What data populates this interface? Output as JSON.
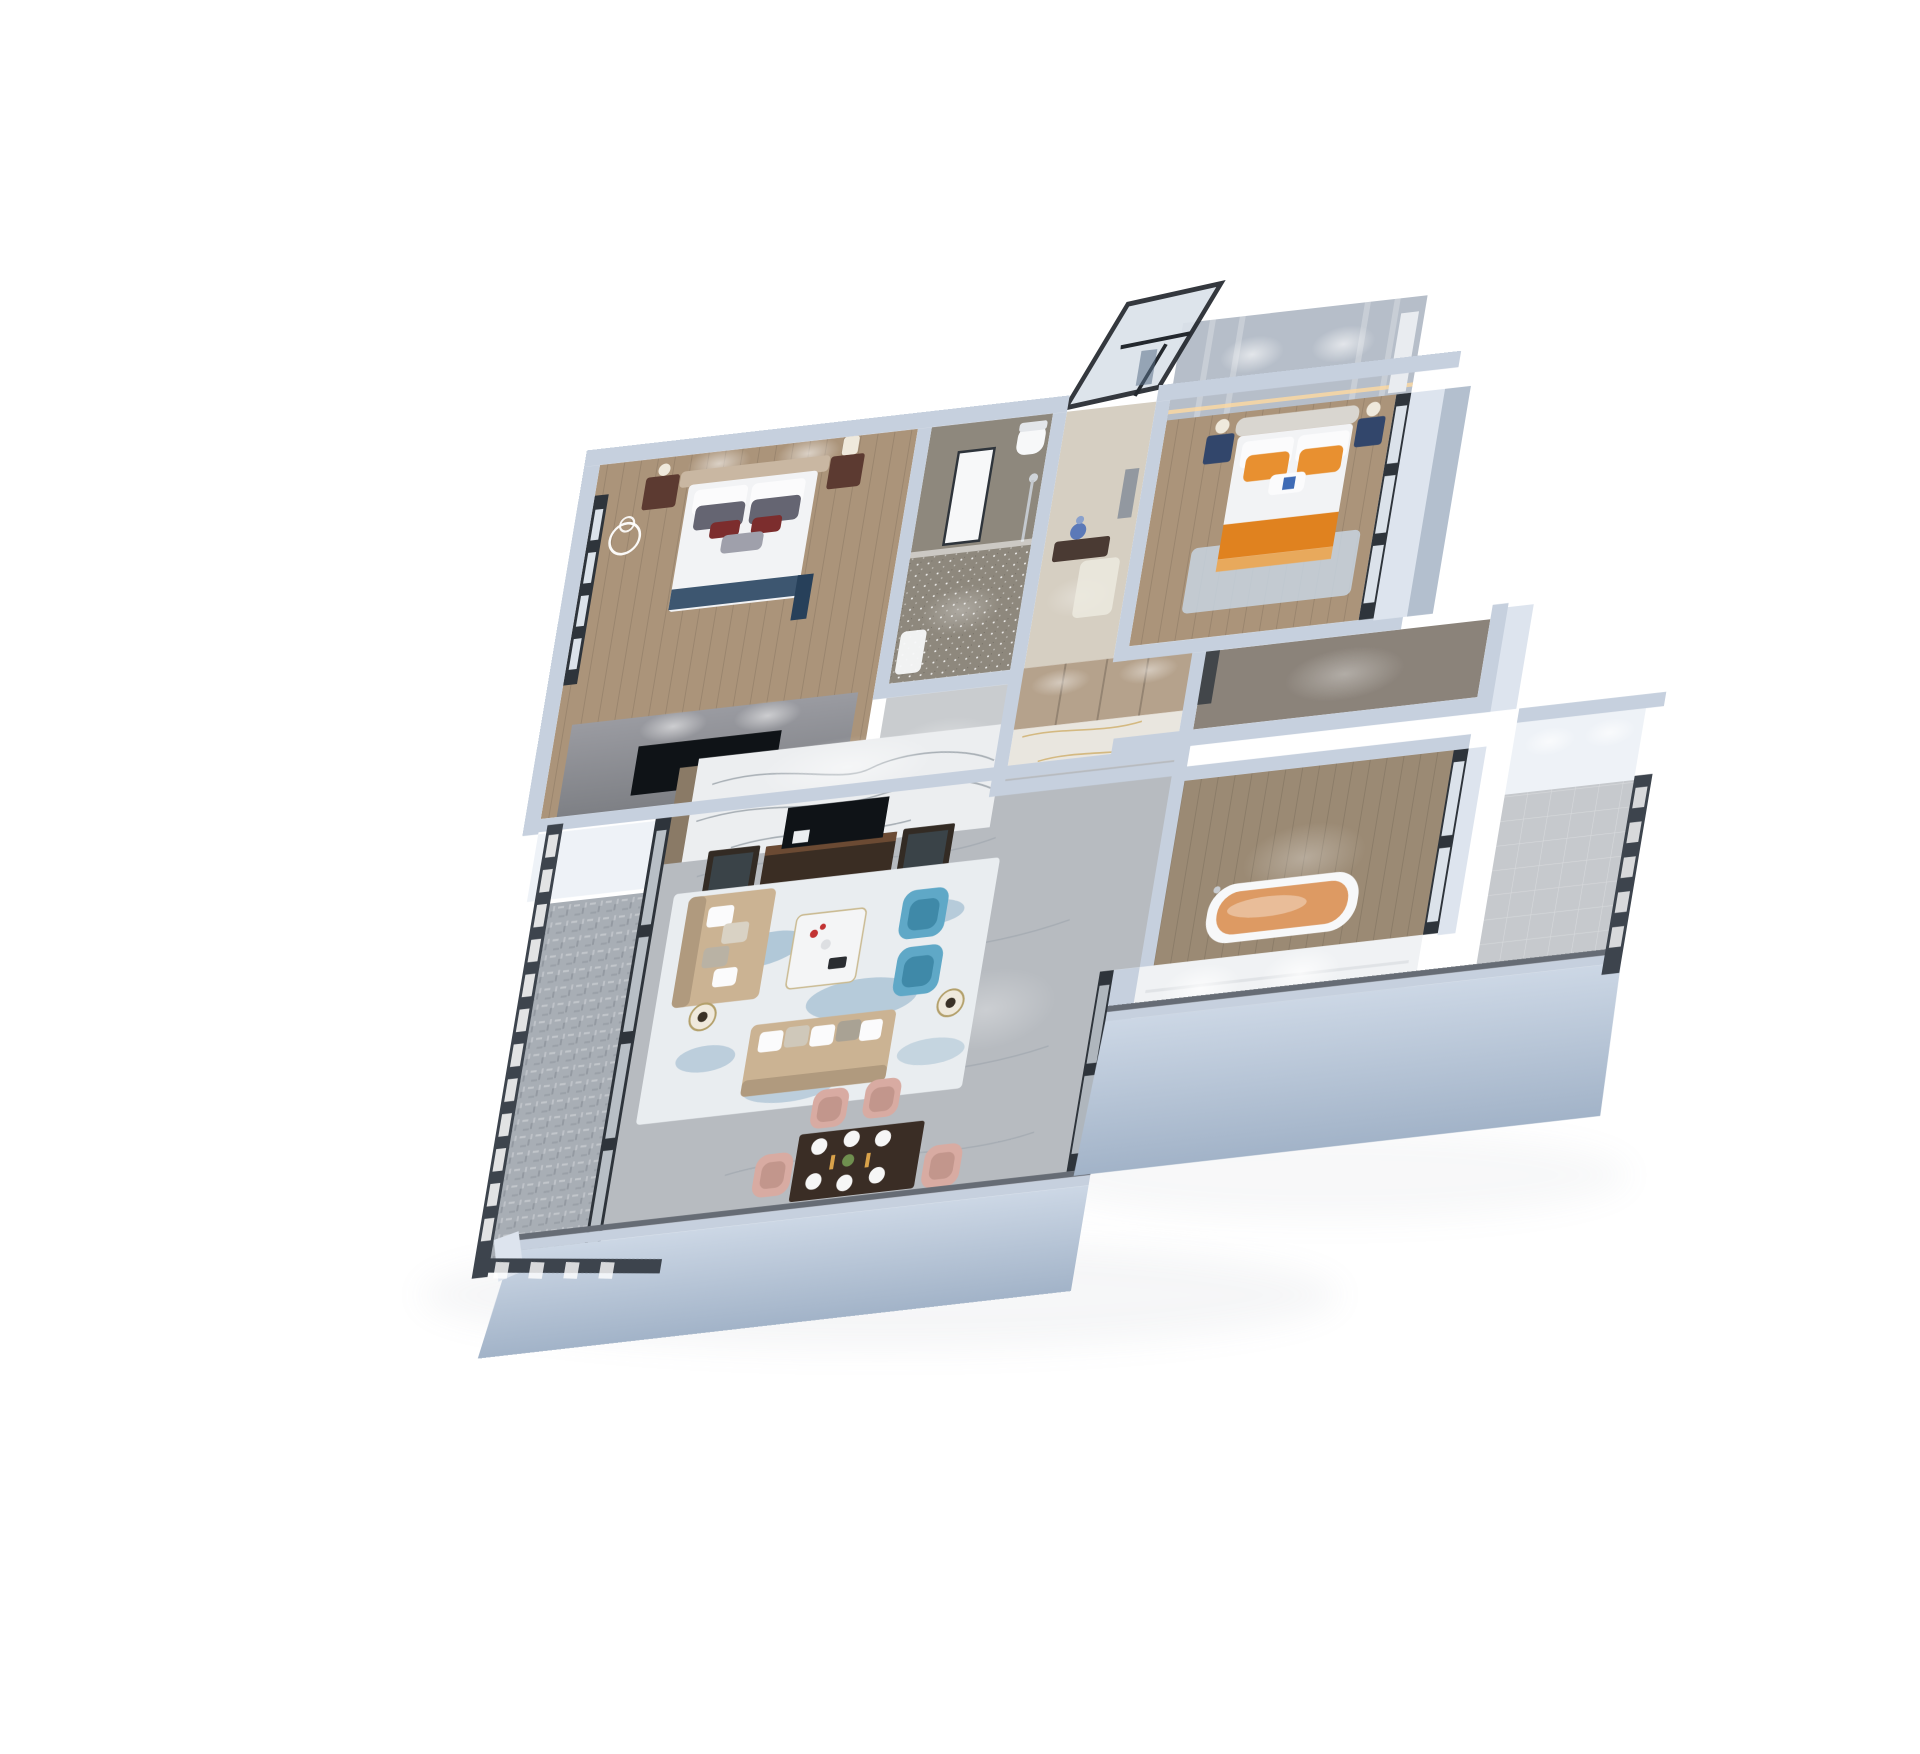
{
  "meta": {
    "type": "3d-floorplan-dollhouse-render",
    "view": "isometric-top-down",
    "background": "#ffffff"
  },
  "colors": {
    "bg": "#ffffff",
    "wall-top": "#c6d0de",
    "wall-top-dim": "#b3bfce",
    "wall-face-light": "#dde4ee",
    "wall-white": "#eef2f7",
    "wall-dark-strip": "#666c75",
    "wall-face-front-top": "#ccd7e5",
    "wall-face-front-bottom": "#a2b3c8",
    "tv-wall": "#8f9196",
    "b2-face": "#b6bec9",
    "marble-white": "#eceef0",
    "bronze": "#8a7a66",
    "cabinet-tan": "#b5a28c",
    "floor-wood": "#ab947a",
    "floor-wood2": "#9b8a74",
    "floor-bath": "#8e887d",
    "floor-entry": "#d6cfc2",
    "floor-hall": "#c9cccf",
    "floor-living": "#b7bbc0",
    "floor-marble-gold": "#e9e6df",
    "floor-closet": "#8b837a",
    "floor-balcony-left": "#a8aeb5",
    "floor-balcony-right": "#c6c9cd",
    "dark-frame": "#2e343b",
    "railing": "#3d444d",
    "glass": "#dbe2ea",
    "sofa": "#cbb393",
    "sofa-shadow": "#b09a7e",
    "chair-blue": "#5fa8c7",
    "chair-blue-dark": "#3f89a8",
    "rug-base": "#e9edf0",
    "rug-blue": "#84a9c4",
    "table-white": "#f4f5f6",
    "lamp-shade": "#efe9dc",
    "lamp-base": "#3a3126",
    "dining-table": "#3a2d25",
    "chair-pink": "#d8aba2",
    "chair-pink-dark": "#c2968c",
    "plate": "#f6f6f6",
    "bed-white": "#f2f3f5",
    "pillow-white": "#fbfbfc",
    "pillow-dark": "#656572",
    "pillow-orange": "#e89030",
    "pillow-maroon": "#7c2d2d",
    "pillow-gray": "#9fa0ab",
    "throw-navy": "#2e4964",
    "throw-orange": "#e0821f",
    "headboard": "#c9b7a2",
    "nightstand-red": "#5c3a31",
    "nightstand-navy": "#32466b",
    "rug-blue-soft": "#c7d4e0",
    "console-wood": "#3a2d23",
    "console-top": "#6b4a33",
    "cabinet-dark": "#332b24",
    "tv-black": "#0f1317",
    "fixture-white": "#f7f8f9",
    "tub-orange": "#dd9a63",
    "accent-gold": "#d9a24a",
    "light-warm": "#ffd9a0",
    "vein": "#98a0a8",
    "vein-gold": "#c9a14e",
    "shadow": "#8a93a0"
  },
  "scene": {
    "rooms": [
      {
        "id": "master-bedroom",
        "floor": "wood"
      },
      {
        "id": "master-tv-wall",
        "floor": "wood"
      },
      {
        "id": "bathroom",
        "floor": "gray-tile"
      },
      {
        "id": "entry-foyer",
        "floor": "light"
      },
      {
        "id": "bedroom-orange",
        "floor": "wood"
      },
      {
        "id": "walk-in-closet",
        "floor": "taupe"
      },
      {
        "id": "laundry-marble-room",
        "floor": "white-gold-marble"
      },
      {
        "id": "hallway",
        "floor": "light-marble"
      },
      {
        "id": "living-room",
        "floor": "gray-marble"
      },
      {
        "id": "dining-area",
        "floor": "gray-marble"
      },
      {
        "id": "bath-tub-room",
        "floor": "wood"
      },
      {
        "id": "balcony-left",
        "floor": "carpet-tiles"
      },
      {
        "id": "balcony-right",
        "floor": "light-tile"
      }
    ],
    "furniture": [
      "master-bed",
      "nightstands",
      "ring-light-sculpture",
      "wall-tv",
      "marble-tv-feature-wall",
      "tv-console",
      "display-cabinets",
      "sofa-long",
      "sofa-side",
      "armchairs-blue",
      "coffee-table",
      "area-rug-blue-white",
      "floor-lamps",
      "dining-table",
      "dining-chairs-pink",
      "place-settings",
      "bed-orange-pillows",
      "blue-figurine",
      "console-table",
      "toilet",
      "standing-mirror",
      "shower-column",
      "freestanding-bathtub",
      "metal-railings",
      "black-frame-windows"
    ]
  }
}
